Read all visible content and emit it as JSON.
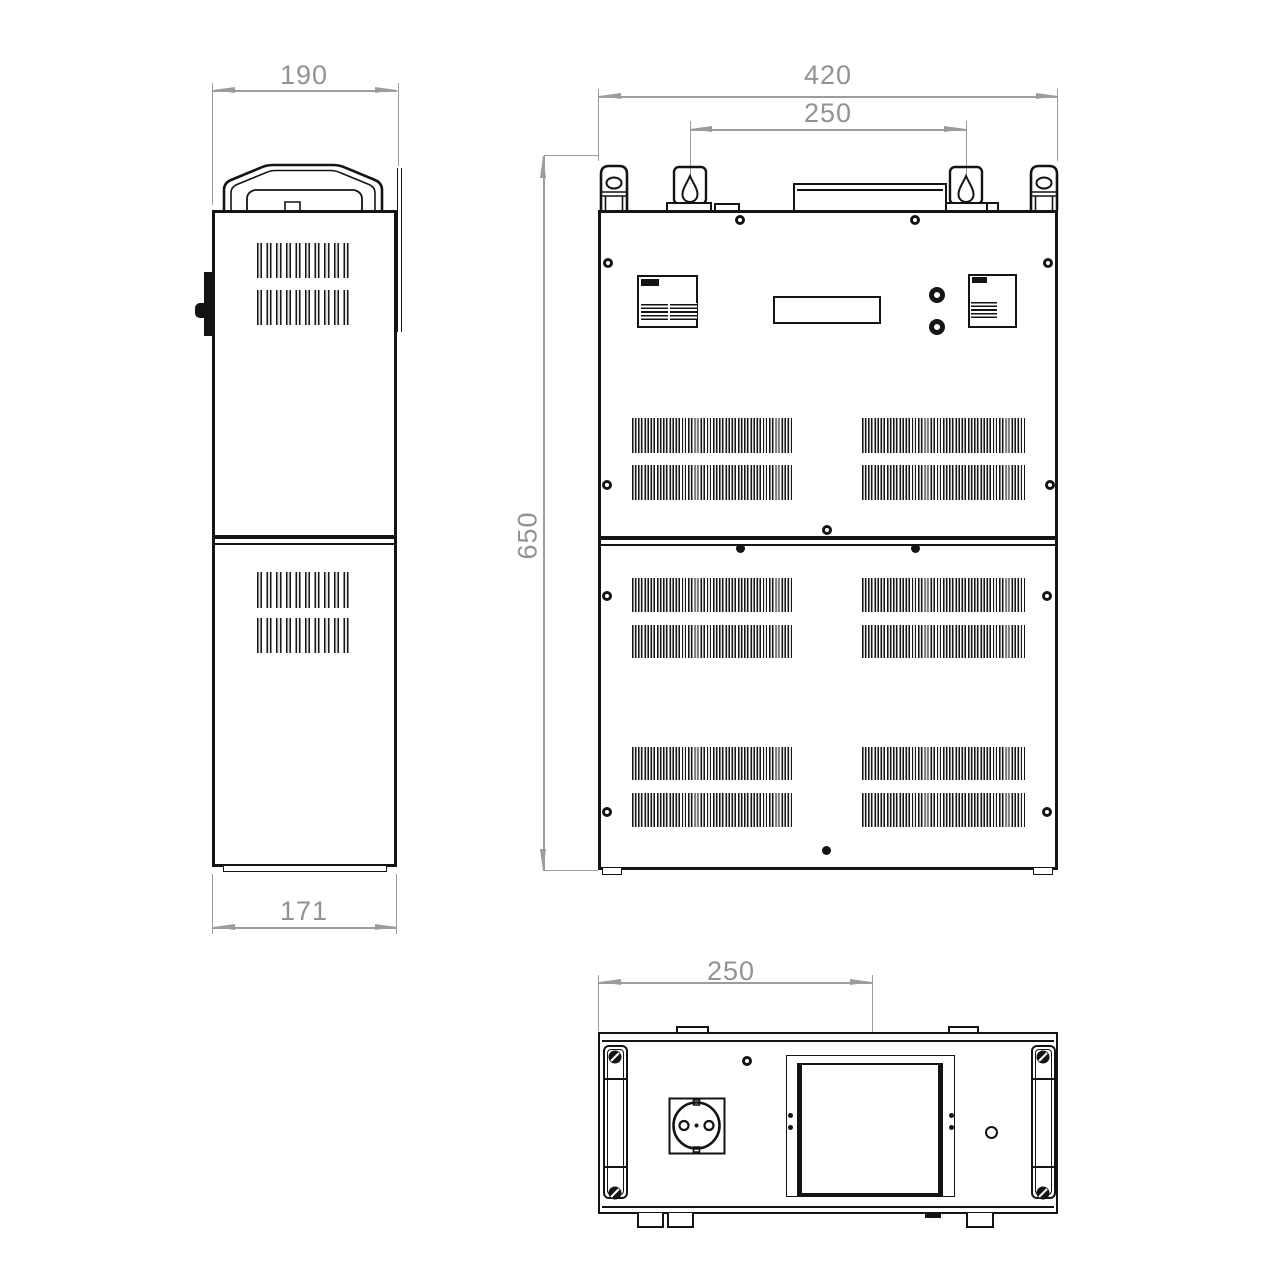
{
  "drawing": {
    "type": "technical-drawing",
    "subject": "voltage stabilizer enclosure, three orthographic views",
    "brand_logo_icon": "volter-logo",
    "colors": {
      "outline": "#141414",
      "dimension": "#9c9c9c",
      "background": "#ffffff"
    },
    "views": {
      "side": {
        "dimensions": {
          "width_top": "190",
          "depth_bottom": "171"
        }
      },
      "front": {
        "dimensions": {
          "width": "420",
          "mount_spacing": "250",
          "height": "650"
        }
      },
      "bottom": {
        "dimensions": {
          "socket_offset": "250"
        }
      }
    }
  }
}
